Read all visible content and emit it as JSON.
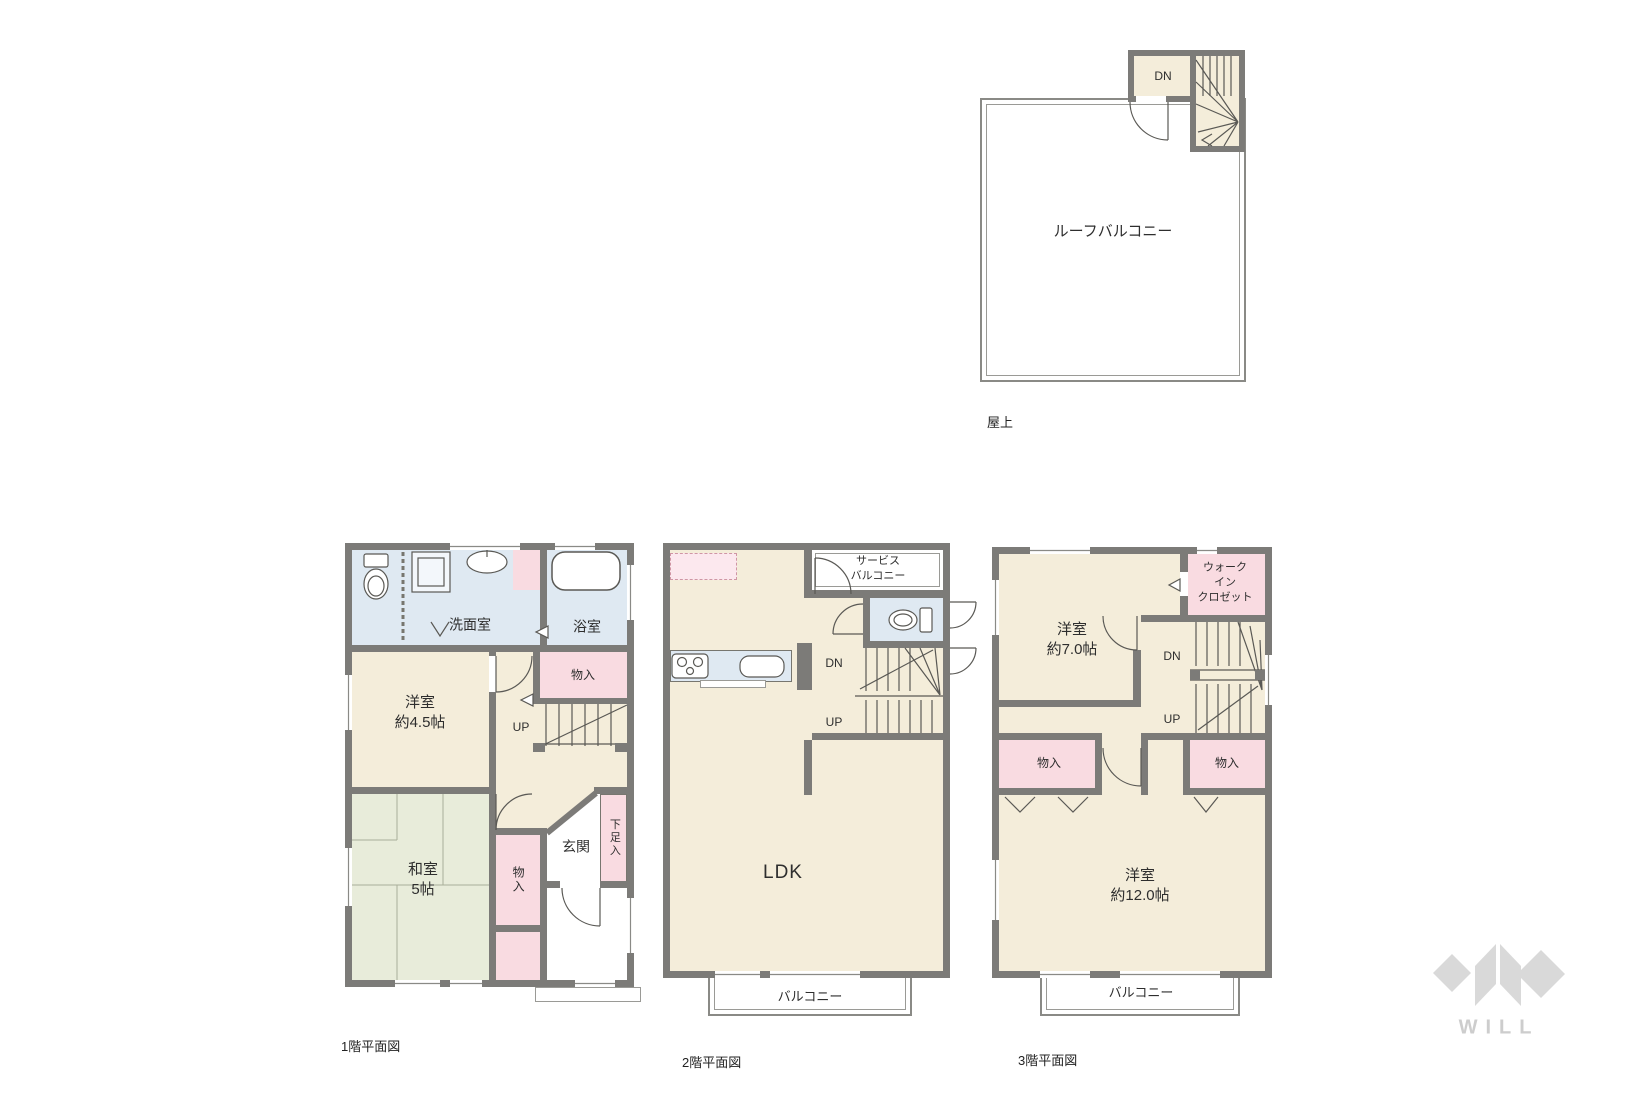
{
  "colors": {
    "wall": "#7c7b78",
    "floor_cream": "#f4edda",
    "storage_pink": "#f9dbe1",
    "wet_area_blue": "#dfe9f2",
    "tatami_green": "#e8ecda",
    "logo_gray": "#d9d9d9"
  },
  "roof_plan": {
    "stair_label": "DN",
    "balcony_label": "ルーフバルコニー",
    "caption": "屋上"
  },
  "floor1_plan": {
    "caption": "1階平面図",
    "washroom_label": "洗面室",
    "bathroom_label": "浴室",
    "storage_upper_label": "物入",
    "stairs_up_label": "UP",
    "western_room_label": "洋室\n約4.5帖",
    "japanese_room_label": "和室\n5帖",
    "storage_hall_label": "物入",
    "entrance_label": "玄関",
    "shoe_storage_label": "下足入"
  },
  "floor2_plan": {
    "caption": "2階平面図",
    "service_balcony_label": "サービス\nバルコニー",
    "stairs_down_label": "DN",
    "stairs_up_label": "UP",
    "ldk_label": "LDK",
    "balcony_label": "バルコニー"
  },
  "floor3_plan": {
    "caption": "3階平面図",
    "western_room7_label": "洋室\n約7.0帖",
    "walk_in_closet_label": "ウォーク\nイン\nクロゼット",
    "stairs_down_label": "DN",
    "stairs_up_label": "UP",
    "storage_left_label": "物入",
    "storage_right_label": "物入",
    "western_room12_label": "洋室\n約12.0帖",
    "balcony_label": "バルコニー"
  },
  "brand": {
    "logo_text": "WILL"
  }
}
